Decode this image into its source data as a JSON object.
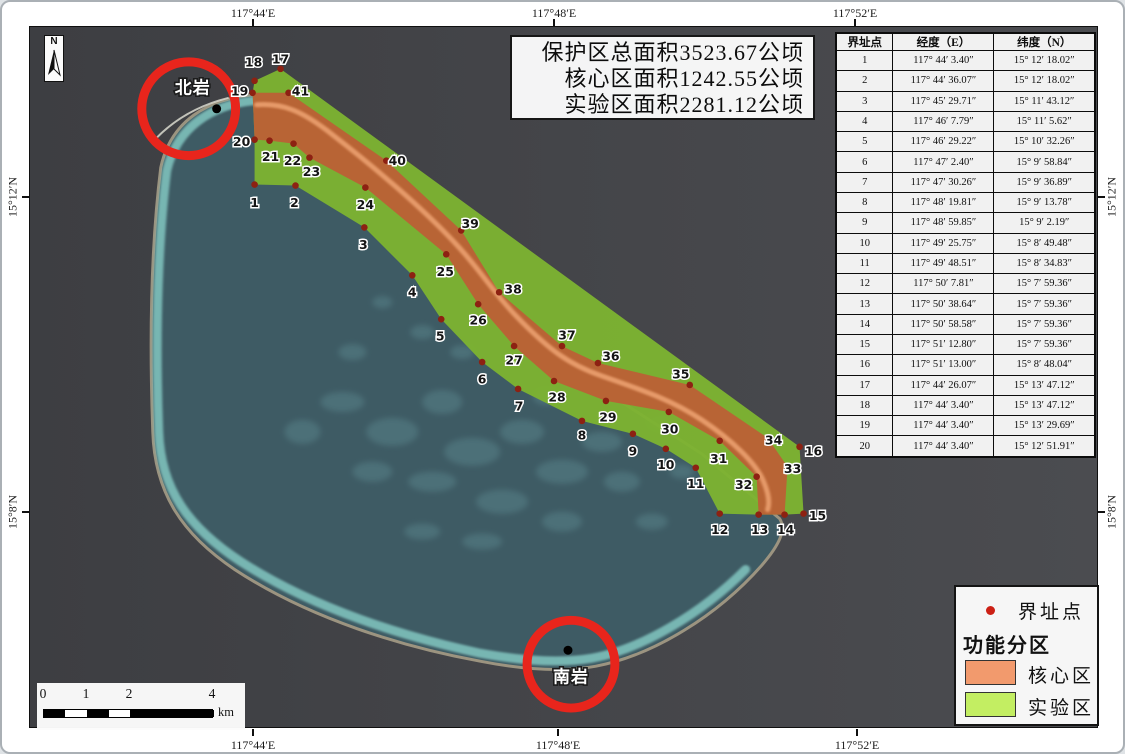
{
  "axes": {
    "top": [
      {
        "text": "117°44′E",
        "x": 251
      },
      {
        "text": "117°48′E",
        "x": 552
      },
      {
        "text": "117°52′E",
        "x": 853
      }
    ],
    "bottom": [
      {
        "text": "117°44′E",
        "x": 251
      },
      {
        "text": "117°48′E",
        "x": 556
      },
      {
        "text": "117°52′E",
        "x": 855
      }
    ],
    "left": [
      {
        "text": "15°12′N",
        "y": 195
      },
      {
        "text": "15°8′N",
        "y": 510
      }
    ],
    "right": [
      {
        "text": "15°12′N",
        "y": 195
      },
      {
        "text": "15°8′N",
        "y": 510
      }
    ]
  },
  "north_arrow": {
    "letter": "N"
  },
  "info_box": {
    "lines": [
      "保护区总面积3523.67公顷",
      "核心区面积1242.55公顷",
      "实验区面积2281.12公顷"
    ]
  },
  "table": {
    "headers": [
      "界址点",
      "经度（E）",
      "纬度（N）"
    ],
    "rows": [
      [
        "1",
        "117° 44′ 3.40″",
        "15° 12′ 18.02″"
      ],
      [
        "2",
        "117° 44′ 36.07″",
        "15° 12′ 18.02″"
      ],
      [
        "3",
        "117° 45′ 29.71″",
        "15° 11′ 43.12″"
      ],
      [
        "4",
        "117° 46′ 7.79″",
        "15° 11′ 5.62″"
      ],
      [
        "5",
        "117° 46′ 29.22″",
        "15° 10′ 32.26″"
      ],
      [
        "6",
        "117° 47′ 2.40″",
        "15° 9′ 58.84″"
      ],
      [
        "7",
        "117° 47′ 30.26″",
        "15° 9′ 36.89″"
      ],
      [
        "8",
        "117° 48′ 19.81″",
        "15° 9′ 13.78″"
      ],
      [
        "9",
        "117° 48′ 59.85″",
        "15° 9′ 2.19″"
      ],
      [
        "10",
        "117° 49′ 25.75″",
        "15° 8′ 49.48″"
      ],
      [
        "11",
        "117° 49′ 48.51″",
        "15° 8′ 34.83″"
      ],
      [
        "12",
        "117° 50′ 7.81″",
        "15° 7′ 59.36″"
      ],
      [
        "13",
        "117° 50′ 38.64″",
        "15° 7′ 59.36″"
      ],
      [
        "14",
        "117° 50′ 58.58″",
        "15° 7′ 59.36″"
      ],
      [
        "15",
        "117° 51′ 12.80″",
        "15° 7′ 59.36″"
      ],
      [
        "16",
        "117° 51′ 13.00″",
        "15° 8′ 48.04″"
      ],
      [
        "17",
        "117° 44′ 26.07″",
        "15° 13′ 47.12″"
      ],
      [
        "18",
        "117° 44′ 3.40″",
        "15° 13′ 47.12″"
      ],
      [
        "19",
        "117° 44′ 3.40″",
        "15° 13′ 29.69″"
      ],
      [
        "20",
        "117° 44′ 3.40″",
        "15° 12′ 51.91″"
      ]
    ]
  },
  "legend": {
    "point_label": "界址点",
    "group_label": "功能分区",
    "dot_color": "#cc2015",
    "items": [
      {
        "label": "核心区",
        "color": "#f29a6d"
      },
      {
        "label": "实验区",
        "color": "#c3ee62"
      }
    ]
  },
  "scale_bar": {
    "labels": [
      {
        "t": "0",
        "x": 6
      },
      {
        "t": "1",
        "x": 49
      },
      {
        "t": "2",
        "x": 92
      },
      {
        "t": "4",
        "x": 175
      }
    ],
    "unit": "km",
    "segments": [
      {
        "x": 0,
        "w": 21,
        "c": "#000000"
      },
      {
        "x": 21,
        "w": 22,
        "c": "#ffffff"
      },
      {
        "x": 43,
        "w": 22,
        "c": "#000000"
      },
      {
        "x": 65,
        "w": 21,
        "c": "#ffffff"
      },
      {
        "x": 86,
        "w": 84,
        "c": "#000000"
      }
    ]
  },
  "landmarks": [
    {
      "name": "北岩",
      "circle": {
        "cx": 186,
        "cy": 106,
        "r": 47
      },
      "dot": {
        "x": 214,
        "y": 106
      },
      "label": {
        "x": 190,
        "y": 85
      }
    },
    {
      "name": "南岩",
      "circle": {
        "cx": 569,
        "cy": 663,
        "r": 44
      },
      "dot": {
        "x": 566,
        "y": 649
      },
      "label": {
        "x": 569,
        "y": 676
      }
    }
  ],
  "points": [
    {
      "n": "1",
      "dx": 252,
      "dy": 182,
      "lx": 252,
      "ly": 200
    },
    {
      "n": "2",
      "dx": 293,
      "dy": 183,
      "lx": 292,
      "ly": 200
    },
    {
      "n": "3",
      "dx": 362,
      "dy": 225,
      "lx": 361,
      "ly": 242
    },
    {
      "n": "4",
      "dx": 410,
      "dy": 273,
      "lx": 410,
      "ly": 290
    },
    {
      "n": "5",
      "dx": 439,
      "dy": 317,
      "lx": 438,
      "ly": 334
    },
    {
      "n": "6",
      "dx": 480,
      "dy": 360,
      "lx": 480,
      "ly": 377
    },
    {
      "n": "7",
      "dx": 516,
      "dy": 387,
      "lx": 517,
      "ly": 404
    },
    {
      "n": "8",
      "dx": 580,
      "dy": 419,
      "lx": 580,
      "ly": 433
    },
    {
      "n": "9",
      "dx": 631,
      "dy": 432,
      "lx": 631,
      "ly": 449
    },
    {
      "n": "10",
      "dx": 664,
      "dy": 447,
      "lx": 664,
      "ly": 463
    },
    {
      "n": "11",
      "dx": 694,
      "dy": 466,
      "lx": 694,
      "ly": 482
    },
    {
      "n": "12",
      "dx": 718,
      "dy": 512,
      "lx": 718,
      "ly": 528
    },
    {
      "n": "13",
      "dx": 757,
      "dy": 513,
      "lx": 758,
      "ly": 528
    },
    {
      "n": "14",
      "dx": 783,
      "dy": 513,
      "lx": 784,
      "ly": 528
    },
    {
      "n": "15",
      "dx": 802,
      "dy": 512,
      "lx": 816,
      "ly": 514
    },
    {
      "n": "16",
      "dx": 798,
      "dy": 445,
      "lx": 812,
      "ly": 449
    },
    {
      "n": "17",
      "dx": 278,
      "dy": 66,
      "lx": 278,
      "ly": 56
    },
    {
      "n": "18",
      "dx": 252,
      "dy": 78,
      "lx": 251,
      "ly": 59
    },
    {
      "n": "19",
      "dx": 250,
      "dy": 90,
      "lx": 237,
      "ly": 88
    },
    {
      "n": "20",
      "dx": 252,
      "dy": 137,
      "lx": 239,
      "ly": 139
    },
    {
      "n": "21",
      "dx": 267,
      "dy": 138,
      "lx": 268,
      "ly": 154
    },
    {
      "n": "22",
      "dx": 291,
      "dy": 141,
      "lx": 290,
      "ly": 158
    },
    {
      "n": "23",
      "dx": 307,
      "dy": 155,
      "lx": 309,
      "ly": 169
    },
    {
      "n": "24",
      "dx": 363,
      "dy": 185,
      "lx": 363,
      "ly": 202
    },
    {
      "n": "25",
      "dx": 444,
      "dy": 252,
      "lx": 443,
      "ly": 269
    },
    {
      "n": "26",
      "dx": 476,
      "dy": 302,
      "lx": 476,
      "ly": 318
    },
    {
      "n": "27",
      "dx": 512,
      "dy": 344,
      "lx": 512,
      "ly": 358
    },
    {
      "n": "28",
      "dx": 552,
      "dy": 379,
      "lx": 555,
      "ly": 395
    },
    {
      "n": "29",
      "dx": 604,
      "dy": 399,
      "lx": 606,
      "ly": 415
    },
    {
      "n": "30",
      "dx": 667,
      "dy": 410,
      "lx": 668,
      "ly": 427
    },
    {
      "n": "31",
      "dx": 718,
      "dy": 439,
      "lx": 717,
      "ly": 457
    },
    {
      "n": "32",
      "dx": 755,
      "dy": 475,
      "lx": 742,
      "ly": 483
    },
    {
      "n": "33",
      "dx": 786,
      "dy": 465,
      "lx": 791,
      "ly": 467
    },
    {
      "n": "34",
      "dx": 766,
      "dy": 436,
      "lx": 772,
      "ly": 438
    },
    {
      "n": "35",
      "dx": 688,
      "dy": 383,
      "lx": 679,
      "ly": 372
    },
    {
      "n": "36",
      "dx": 596,
      "dy": 361,
      "lx": 609,
      "ly": 354
    },
    {
      "n": "37",
      "dx": 560,
      "dy": 344,
      "lx": 565,
      "ly": 333
    },
    {
      "n": "38",
      "dx": 497,
      "dy": 290,
      "lx": 511,
      "ly": 287
    },
    {
      "n": "39",
      "dx": 459,
      "dy": 228,
      "lx": 468,
      "ly": 221
    },
    {
      "n": "40",
      "dx": 384,
      "dy": 158,
      "lx": 395,
      "ly": 158
    },
    {
      "n": "41",
      "dx": 286,
      "dy": 90,
      "lx": 298,
      "ly": 88
    }
  ],
  "map_geometry": {
    "outer_green": "252,78 278,66 798,445 802,512 783,513 757,513 718,512 694,466 664,447 631,432 580,419 516,387 480,360 439,317 410,273 362,225 293,183 252,182 252,137 250,90",
    "core_orange": "250,90 286,90 384,158 459,228 497,290 560,344 596,361 688,383 766,436 786,465 783,513 757,513 755,475 718,439 667,410 604,399 552,379 512,344 476,302 444,252 363,185 307,155 291,141 267,138 252,137",
    "center_line": "M 254,102 C 280,100 300,108 330,132 C 370,163 420,205 455,243 C 480,270 492,292 520,320 C 545,345 565,362 600,374 C 640,388 670,398 700,418 C 730,438 755,462 762,480 C 768,494 768,502 766,508",
    "atoll_body": "M 252,92 C 205,96 168,118 158,165 C 150,230 146,320 150,430 C 152,492 180,533 232,568 C 308,618 402,646 478,660 C 524,669 562,671 594,665 C 652,654 716,614 760,564 C 778,543 785,528 778,517 L 700,452 L 598,386 L 518,312 L 428,230 L 330,138 Z",
    "west_rim": "M 250,98 C 210,102 174,124 164,168 C 156,232 152,322 156,430 C 158,488 186,526 238,560 C 312,608 404,636 478,652 C 522,660 560,662 590,657 C 640,648 700,612 744,568",
    "reef_line": "M 153,136 Q 182,106 226,95",
    "mottle": [
      [
        300,
        430,
        18,
        12
      ],
      [
        340,
        400,
        22,
        10
      ],
      [
        390,
        430,
        26,
        14
      ],
      [
        440,
        400,
        20,
        12
      ],
      [
        470,
        450,
        28,
        14
      ],
      [
        520,
        430,
        22,
        12
      ],
      [
        560,
        470,
        26,
        12
      ],
      [
        600,
        440,
        20,
        10
      ],
      [
        430,
        480,
        24,
        10
      ],
      [
        370,
        470,
        20,
        10
      ],
      [
        500,
        500,
        26,
        12
      ],
      [
        560,
        520,
        20,
        10
      ],
      [
        620,
        480,
        18,
        10
      ],
      [
        650,
        520,
        16,
        8
      ],
      [
        480,
        540,
        20,
        8
      ],
      [
        420,
        530,
        18,
        8
      ],
      [
        350,
        350,
        14,
        8
      ],
      [
        420,
        330,
        12,
        7
      ],
      [
        380,
        300,
        10,
        6
      ],
      [
        460,
        350,
        12,
        7
      ],
      [
        620,
        380,
        16,
        8
      ],
      [
        660,
        420,
        14,
        8
      ],
      [
        680,
        470,
        12,
        7
      ],
      [
        545,
        395,
        14,
        8
      ]
    ]
  },
  "colors": {
    "sea_left": "#3d3e42",
    "sea_right": "#4b4c50",
    "lagoon": "#3e5b64",
    "lagoon_rim": "#7ec0bb",
    "sand": "#9c9480",
    "mottle": "#628e97",
    "green_zone": "#7db331",
    "orange_zone": "#ba6136",
    "center_line": "#efa473",
    "point_dot": "#8d2112",
    "landmark_circle": "#e8251c",
    "reef_line": "#d9d9ce"
  }
}
